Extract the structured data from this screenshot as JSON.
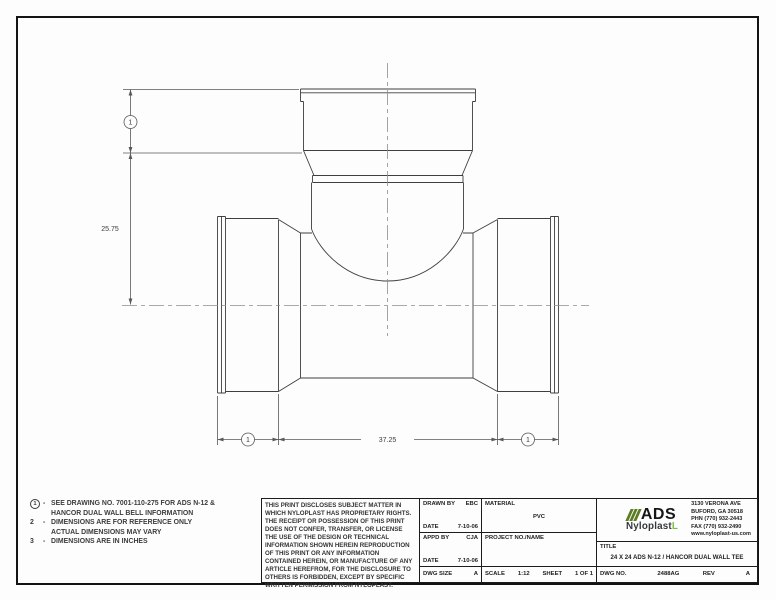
{
  "drawing": {
    "balloon_label": "1",
    "dim_vertical": "25.75",
    "dim_horizontal": "37.25"
  },
  "notes": {
    "items": [
      {
        "num": "1",
        "line1": "SEE DRAWING NO. 7001-110-275 FOR ADS N-12 &",
        "line2": "HANCOR DUAL WALL BELL INFORMATION"
      },
      {
        "num": "2",
        "line1": "DIMENSIONS ARE FOR REFERENCE ONLY",
        "line2": "ACTUAL DIMENSIONS MAY VARY"
      },
      {
        "num": "3",
        "line1": "DIMENSIONS ARE IN INCHES",
        "line2": ""
      }
    ]
  },
  "disclaimer": "THIS PRINT DISCLOSES SUBJECT MATTER IN WHICH NYLOPLAST HAS PROPRIETARY RIGHTS.  THE RECEIPT OR POSSESSION OF THIS PRINT DOES NOT CONFER, TRANSFER, OR LICENSE THE USE OF THE DESIGN OR TECHNICAL INFORMATION SHOWN HEREIN REPRODUCTION OF THIS PRINT OR ANY INFORMATION CONTAINED HEREIN, OR MANUFACTURE OF ANY ARTICLE HEREFROM, FOR THE DISCLOSURE TO OTHERS IS FORBIDDEN, EXCEPT BY SPECIFIC WRITTEN PERMISSION FROM NYLOPLAST.",
  "title_block": {
    "drawn_by_label": "DRAWN BY",
    "drawn_by": "EBC",
    "date_label": "DATE",
    "date1": "7-10-06",
    "appd_by_label": "APPD BY",
    "appd_by": "CJA",
    "date2": "7-10-06",
    "dwg_size_label": "DWG SIZE",
    "dwg_size": "A",
    "material_label": "MATERIAL",
    "material": "PVC",
    "project_label": "PROJECT NO./NAME",
    "scale_label": "SCALE",
    "scale": "1:12",
    "sheet_label": "SHEET",
    "sheet": "1 OF 1",
    "title_label": "TITLE",
    "title": "24 X 24 ADS N-12 / HANCOR DUAL WALL TEE",
    "dwg_no_label": "DWG NO.",
    "dwg_no": "2488AG",
    "rev_label": "REV",
    "rev": "A"
  },
  "company": {
    "logo_ads": "ADS",
    "logo_nyloplast": "Nyloplast",
    "logo_accent": "L",
    "brand_green": "#5d7d23",
    "accent_green": "#7ac143",
    "address_lines": [
      "3130 VERONA AVE",
      "BUFORD, GA 30518",
      "PHN (770) 932-2443",
      "FAX (770) 932-2490",
      "www.nyloplast-us.com"
    ]
  }
}
